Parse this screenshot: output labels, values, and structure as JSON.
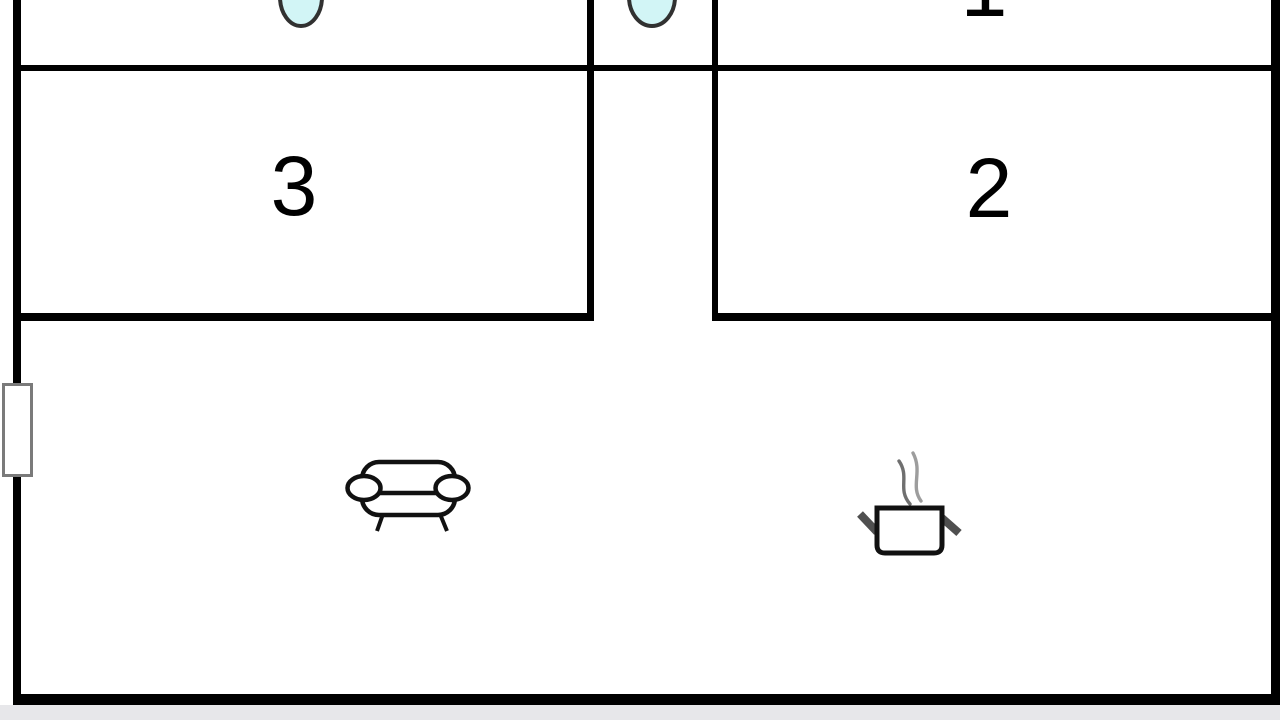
{
  "floor_plan": {
    "title": "apartment-floor-plan",
    "rooms": [
      {
        "id": "room-1",
        "label": "1"
      },
      {
        "id": "room-2",
        "label": "2"
      },
      {
        "id": "room-3",
        "label": "3"
      }
    ],
    "fixtures": {
      "basins": [
        {
          "name": "basin-room-3",
          "location": "top-left-room"
        },
        {
          "name": "basin-hallway",
          "location": "top-hallway"
        }
      ],
      "sofa": {
        "name": "sofa",
        "location": "living-area-left"
      },
      "pot": {
        "name": "cooking-pot-with-steam",
        "location": "living-area-right"
      },
      "window": {
        "name": "window-marker",
        "location": "left-wall"
      }
    },
    "colors": {
      "wall": "#000000",
      "floor": "#ffffff",
      "basin_fill": "#d2f5f6",
      "basin_stroke": "#313131",
      "window_frame": "#7a7a7a",
      "outside_strip": "#e7e7ea",
      "icon_stroke": "#111111",
      "icon_fill": "#ffffff",
      "pot_handle": "#4f4f4f",
      "steam_left": "#6f6f6f",
      "steam_right": "#9d9d9d"
    }
  }
}
